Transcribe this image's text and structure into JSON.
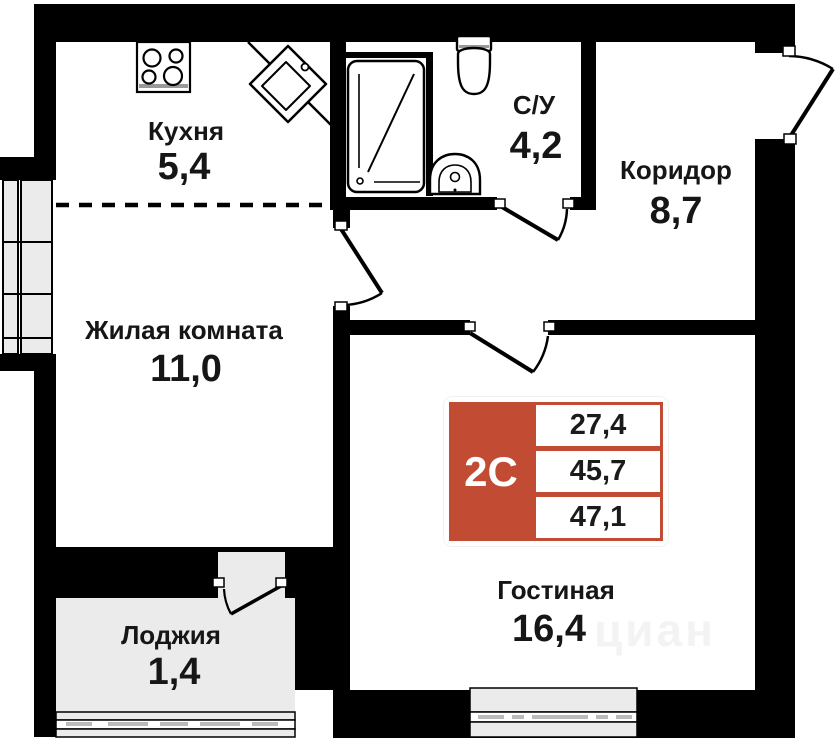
{
  "plan": {
    "title": "Floor plan of a 2C apartment",
    "rooms": [
      {
        "id": "kitchen",
        "name": "Кухня",
        "area": "5,4"
      },
      {
        "id": "bathroom",
        "name": "С/У",
        "area": "4,2"
      },
      {
        "id": "corridor",
        "name": "Коридор",
        "area": "8,7"
      },
      {
        "id": "living-room",
        "name": "Жилая комната",
        "area": "11,0"
      },
      {
        "id": "lounge",
        "name": "Гостиная",
        "area": "16,4"
      },
      {
        "id": "loggia",
        "name": "Лоджия",
        "area": "1,4"
      }
    ],
    "badge": {
      "type_label": "2С",
      "values": [
        "27,4",
        "45,7",
        "47,1"
      ],
      "accent_color": "#c14b33"
    },
    "watermark": "циан",
    "icons": [
      "stove-icon",
      "kitchen-sink-icon",
      "bathtub-icon",
      "toilet-icon",
      "washbasin-icon"
    ],
    "colors": {
      "wall": "#000000",
      "window_fill": "#ebebeb",
      "badge_red": "#c14b33",
      "text": "#161616"
    }
  }
}
